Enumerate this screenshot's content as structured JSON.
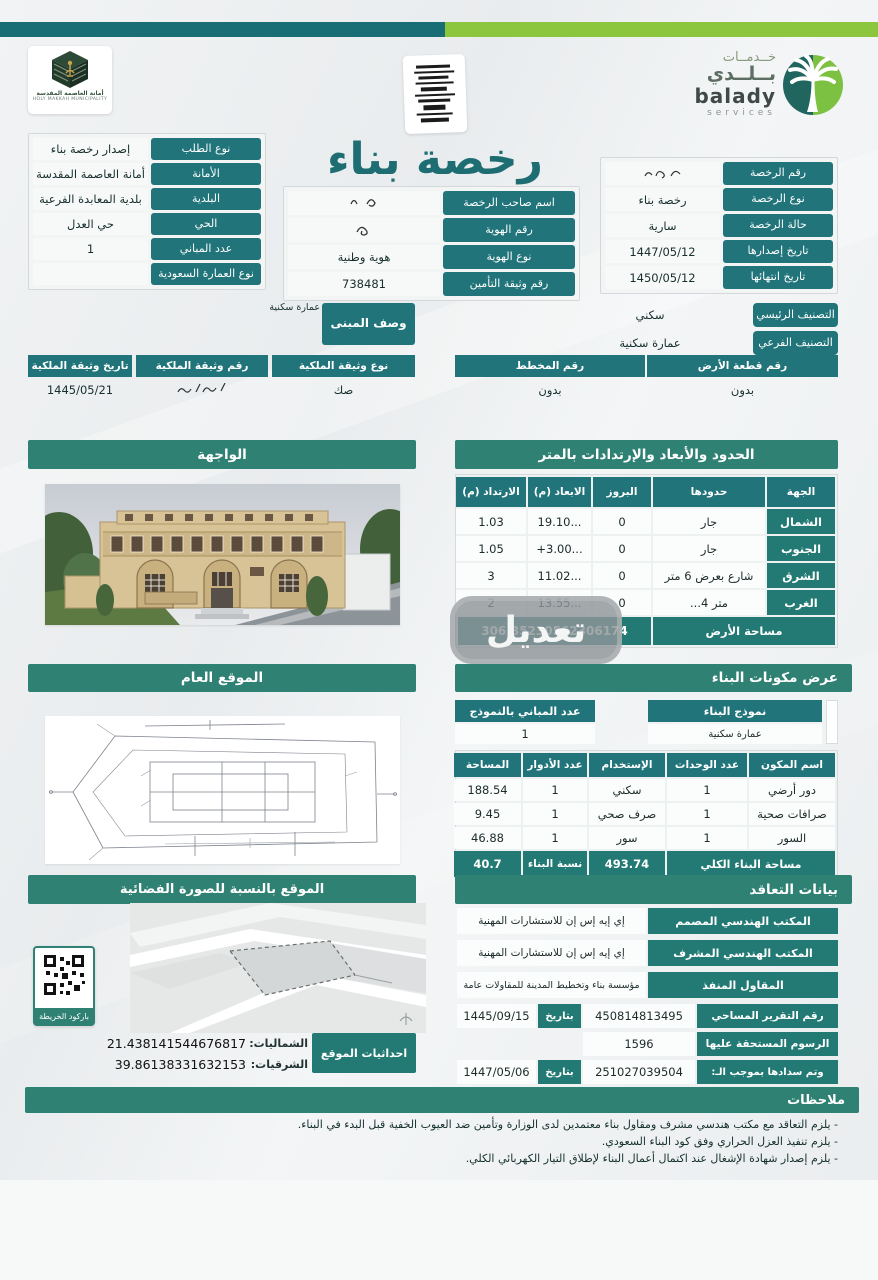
{
  "logos": {
    "municipality": {
      "ar": "أمانة العاصمة المقدسة",
      "en": "HOLY MAKKAH MUNICIPALITY"
    },
    "balady": {
      "ar_line1": "خــدمــات",
      "ar_line2": "بــلــدي",
      "en_line1": "balady",
      "en_line2": "services"
    }
  },
  "title": "رخصة بناء",
  "request": {
    "rows": [
      {
        "label": "نوع الطلب",
        "value": "إصدار رخصة بناء"
      },
      {
        "label": "الأمانة",
        "value": "أمانة العاصمة المقدسة"
      },
      {
        "label": "البلدية",
        "value": "بلدية المعابدة الفرعية"
      },
      {
        "label": "الحي",
        "value": "حي العدل"
      },
      {
        "label": "عدد المباني",
        "value": "1"
      },
      {
        "label": "نوع العمارة السعودية",
        "value": ""
      }
    ]
  },
  "owner": {
    "rows": [
      {
        "label": "اسم صاحب الرخصة",
        "redacted": true
      },
      {
        "label": "رقم الهوية",
        "redacted": true
      },
      {
        "label": "نوع الهوية",
        "value": "هوية وطنية"
      },
      {
        "label": "رقم وثيقة التأمين",
        "value": "738481"
      }
    ]
  },
  "license": {
    "rows": [
      {
        "label": "رقم الرخصة",
        "redacted": true
      },
      {
        "label": "نوع الرخصة",
        "value": "رخصة بناء"
      },
      {
        "label": "حالة الرخصة",
        "value": "سارية"
      },
      {
        "label": "تاريخ إصدارها",
        "value": "1447/05/12"
      },
      {
        "label": "تاريخ انتهائها",
        "value": "1450/05/12"
      }
    ]
  },
  "building": {
    "desc_label": "وصف المبنى",
    "desc_value": "عمارة سكنية",
    "class_main_label": "التصنيف الرئيسي",
    "class_main_value": "سكني",
    "class_sub_label": "التصنيف الفرعي",
    "class_sub_value": "عمارة سكنية",
    "plot_header_right": "رقم قطعة الأرض",
    "plot_header_left": "رقم المخطط",
    "plot_value_right": "بدون",
    "plot_value_left": "بدون",
    "deed_type_label": "نوع وثيقة الملكية",
    "deed_num_label": "رقم وثيقة الملكية",
    "deed_date_label": "تاريخ وثيقة الملكية",
    "deed_type": "صك",
    "deed_date": "1445/05/21"
  },
  "facade": {
    "title": "الواجهة"
  },
  "boundaries": {
    "title": "الحدود والأبعاد والإرتدادات بالمتر",
    "headers": [
      "الجهة",
      "حدودها",
      "البروز",
      "الابعاد (م)",
      "الارتداد (م)"
    ],
    "rows": [
      {
        "side": "الشمال",
        "limit": "جار",
        "prot": "0",
        "dim": "19.10...",
        "set": "1.03"
      },
      {
        "side": "الجنوب",
        "limit": "جار",
        "prot": "0",
        "dim": "+3.00...",
        "set": "1.05"
      },
      {
        "side": "الشرق",
        "limit": "شارع بعرض 6 متر",
        "prot": "0",
        "dim": "11.02...",
        "set": "3"
      },
      {
        "side": "الغرب",
        "limit": "...4 متر",
        "prot": "0",
        "dim": "13.55...",
        "set": "2"
      }
    ],
    "area_label": "مساحة الأرض",
    "area_value": "306.35230562306174"
  },
  "site": {
    "title": "الموقع العام"
  },
  "components": {
    "title": "عرض مكونات البناء",
    "model_label": "نموذج البناء",
    "model_value": "عمارة سكنية",
    "count_label": "عدد المباني بالنموذج",
    "count_value": "1",
    "headers": [
      "اسم المكون",
      "عدد الوحدات",
      "الإستخدام",
      "عدد الأدوار",
      "المساحة"
    ],
    "rows": [
      {
        "name": "دور أرضي",
        "units": "1",
        "use": "سكني",
        "floors": "1",
        "area": "188.54"
      },
      {
        "name": "صرافات صحية",
        "units": "1",
        "use": "صرف صحي",
        "floors": "1",
        "area": "9.45"
      },
      {
        "name": "السور",
        "units": "1",
        "use": "سور",
        "floors": "1",
        "area": "46.88"
      }
    ],
    "total_label": "مساحة البناء الكلي",
    "total_value": "493.74",
    "ratio_label": "نسبة البناء",
    "ratio_value": "40.7"
  },
  "satellite": {
    "title": "الموقع بالنسبة للصورة الفضائية",
    "qr_label": "باركود الخريطة",
    "coords_label": "احداثيات الموقع",
    "north_label": "الشماليات:",
    "north_value": "21.438141544676817",
    "east_label": "الشرقيات:",
    "east_value": "39.86138331632153"
  },
  "contract": {
    "title": "بيانات التعاقد",
    "rows": [
      {
        "label": "المكتب الهندسي المصمم",
        "value": "إي إيه إس إن للاستشارات المهنية"
      },
      {
        "label": "المكتب الهندسي المشرف",
        "value": "إي إيه إس إن للاستشارات المهنية"
      },
      {
        "label": "المقاول المنفذ",
        "value": "مؤسسة بناء وتخطيط المدينة للمقاولات عامة"
      }
    ],
    "survey_label": "رقم التقرير المساحي",
    "survey_value": "450814813495",
    "date_label": "بتاريخ",
    "survey_date": "1445/09/15",
    "fees_label": "الرسوم المستحقة عليها",
    "fees_value": "1596",
    "paid_label": "وتم سدادها بموجب الـ:",
    "paid_value": "251027039504",
    "paid_date": "1447/05/06"
  },
  "notes": {
    "title": "ملاحظات",
    "items": [
      "- يلزم التعاقد مع مكتب هندسي مشرف ومقاول بناء معتمدين لدى الوزارة وتأمين ضد العيوب الخفية قبل البدء في البناء.",
      "- يلزم تنفيذ العزل الحراري وفق كود البناء السعودي.",
      "- يلزم إصدار شهادة الإشغال عند اكتمال أعمال البناء لإطلاق التيار الكهربائي الكلي."
    ]
  },
  "watermark": {
    "text": "تعديل"
  },
  "colors": {
    "teal_cell": "#20747a",
    "section_bar": "#2f8173",
    "topbar_teal": "#186e74",
    "topbar_green": "#8cc63f"
  }
}
